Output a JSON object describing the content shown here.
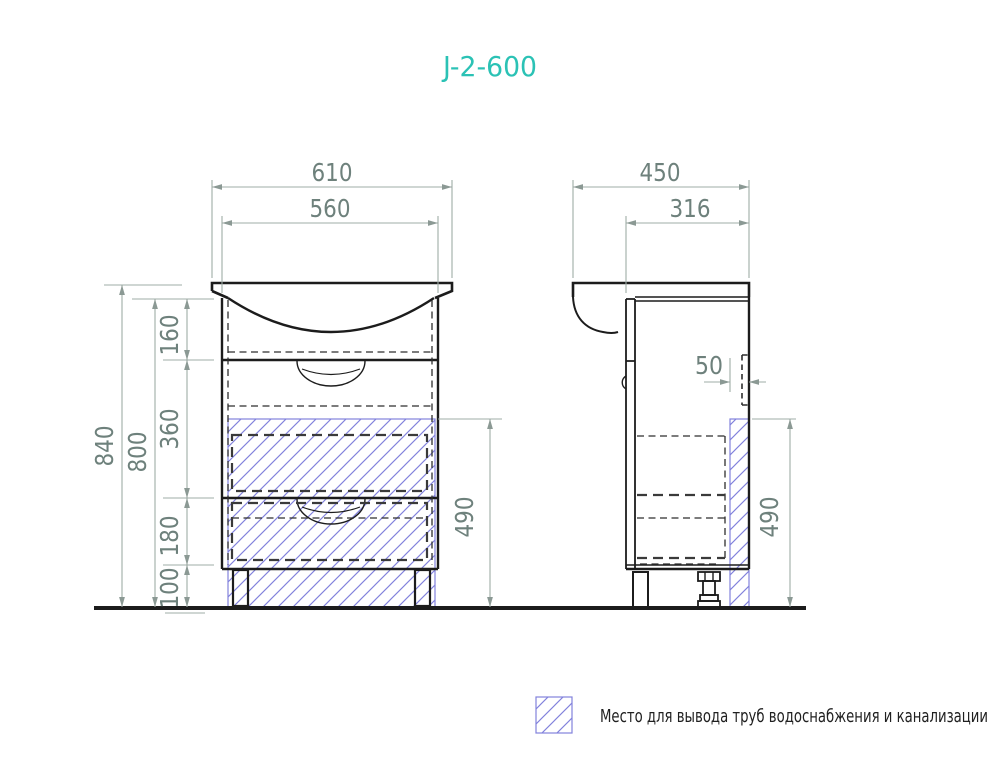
{
  "title": "J-2-600",
  "colors": {
    "accent": "#2BC2B5",
    "hatch_blue": "#8282DC",
    "dimension_line": "#9FACA7",
    "dimension_text": "#6E817C",
    "drawing_line": "#1C1C1C"
  },
  "front_view": {
    "dims": {
      "overall_width": "610",
      "body_width": "560",
      "overall_height": "840",
      "body_height": "800",
      "sink_section_height": "160",
      "upper_drawer_height": "360",
      "lower_drawer_height": "180",
      "leg_height": "100",
      "service_zone_height": "490"
    }
  },
  "side_view": {
    "dims": {
      "overall_depth": "450",
      "inner_depth": "316",
      "service_zone_width": "50",
      "service_zone_height": "490"
    }
  },
  "legend": {
    "label": "Место для вывода труб водоснабжения и канализации"
  }
}
